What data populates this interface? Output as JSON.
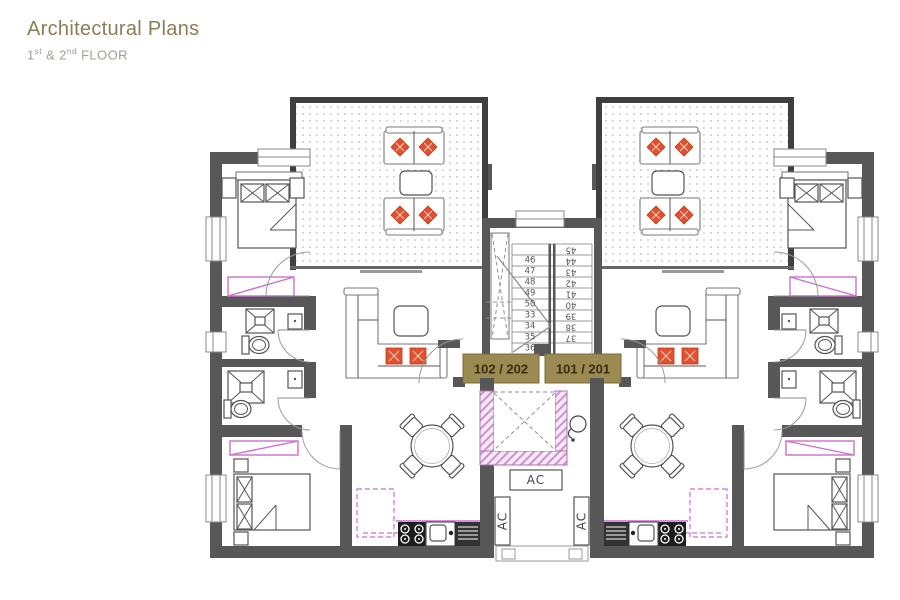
{
  "header": {
    "title": "Architectural Plans",
    "subtitle": {
      "floor1": "1",
      "floor1_sup": "st",
      "mid": " & ",
      "floor2": "2",
      "floor2_sup": "nd",
      "tail": " FLOOR"
    }
  },
  "plan": {
    "unit_labels": {
      "left": "102 / 202",
      "right": "101 / 201"
    },
    "ac": {
      "top": "AC",
      "left": "AC",
      "right": "AC"
    },
    "stairs": {
      "left_upper": [
        "46",
        "47",
        "48",
        "49",
        "50"
      ],
      "left_lower": [
        "33",
        "34",
        "35",
        "36"
      ],
      "right": [
        "45",
        "44",
        "43",
        "42",
        "41",
        "40",
        "39",
        "38",
        "37"
      ]
    },
    "colors": {
      "wall": "#575757",
      "balcony_wall": "#3f3f3f",
      "accent_tan": "#9b8a52",
      "label_text": "#3a2c0e",
      "cushion_orange": "#e4502e",
      "magenta": "#cc6fcc",
      "elevator_hatch_pink": "#f6e9f6",
      "title": "#8b7d55",
      "subtitle": "#9e9e96"
    }
  }
}
